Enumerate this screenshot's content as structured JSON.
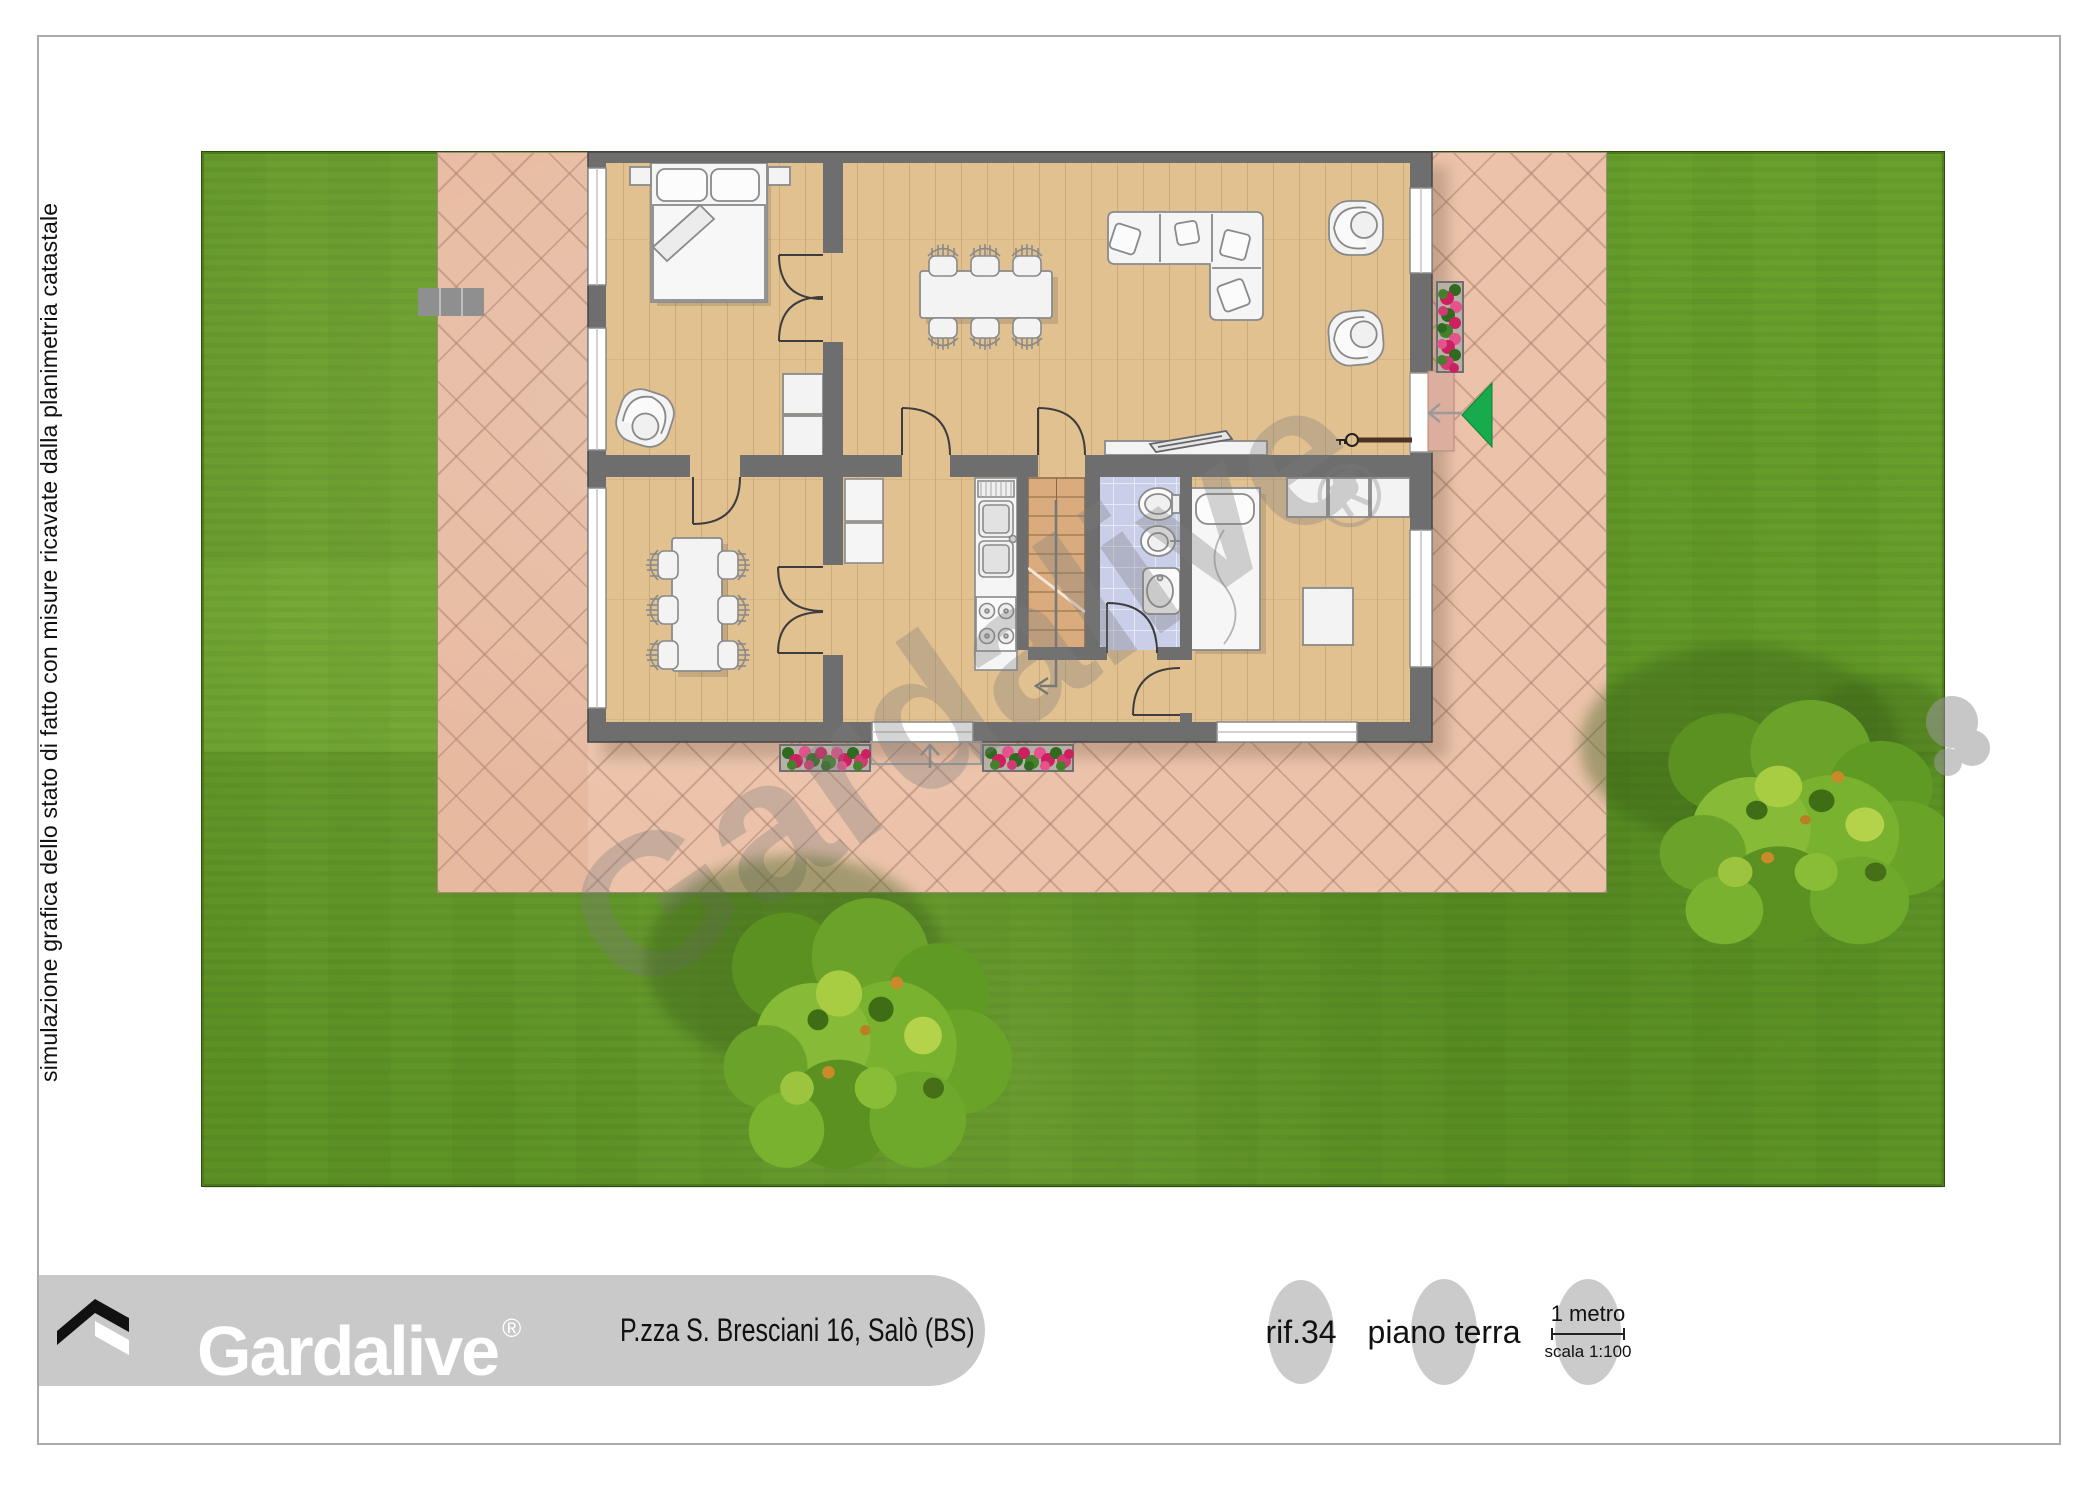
{
  "side_note": "simulazione grafica dello stato di fatto con misure ricavate dalla planimetria catastale",
  "watermark": {
    "text": "Gardalive",
    "registered_mark": "®"
  },
  "footer": {
    "brand": {
      "name": "Gardalive",
      "registered_mark": "®",
      "logo_icon": "gardalive-roof-icon"
    },
    "address": "P.zza S. Bresciani 16, Salò (BS)",
    "reference": "rif.34",
    "floor_label": "piano terra",
    "scale": {
      "bar_label": "1 metro",
      "ratio": "scala 1:100"
    }
  },
  "plan": {
    "type": "residential-floor-plan",
    "rooms": [
      {
        "icon": "bedroom-icon",
        "position": "top-left",
        "furniture": [
          "double-bed-icon",
          "nightstand-icon",
          "nightstand-icon",
          "armchair-icon",
          "cabinet-icon"
        ]
      },
      {
        "icon": "living-room-icon",
        "position": "top-center",
        "furniture": [
          "dining-table-icon",
          "chair-icon",
          "chair-icon",
          "chair-icon",
          "chair-icon",
          "chair-icon",
          "chair-icon",
          "corner-sofa-icon",
          "armchair-icon",
          "armchair-icon",
          "tv-sideboard-icon"
        ]
      },
      {
        "icon": "dining-room-icon",
        "position": "bottom-left",
        "furniture": [
          "table-icon",
          "chair-icon",
          "chair-icon",
          "chair-icon",
          "chair-icon",
          "chair-icon",
          "chair-icon"
        ]
      },
      {
        "icon": "kitchen-icon",
        "position": "bottom-center",
        "furniture": [
          "fridge-icon",
          "sink-icon",
          "stove-icon"
        ]
      },
      {
        "icon": "staircase-icon",
        "position": "bottom-center",
        "furniture": [
          "stairs-direction-arrow-icon"
        ]
      },
      {
        "icon": "bathroom-icon",
        "position": "bottom-center",
        "furniture": [
          "toilet-icon",
          "bidet-icon",
          "washbasin-icon"
        ]
      },
      {
        "icon": "bedroom-icon",
        "position": "bottom-right",
        "furniture": [
          "double-bed-icon",
          "wardrobe-icon",
          "ottoman-icon"
        ]
      }
    ],
    "outdoor": [
      "lawn",
      "paved-patio",
      "tree-icon",
      "tree-icon",
      "flower-planter-icon",
      "flower-planter-icon",
      "flower-planter-icon",
      "entrance-arrow-icon",
      "doormat-icon",
      "garden-steps-icon"
    ],
    "markers": [
      "entrance-arrow-icon",
      "door-key-icon",
      "path-arrow-icon",
      "stairs-direction-arrow-icon"
    ]
  },
  "colors": {
    "lawn": "#6aa12c",
    "patio": "#ecc3aa",
    "wall": "#6e6e6e",
    "wood_floor": "#e2c191",
    "bathroom_tile": "#c9cee9",
    "stairs": "#d9ab7d",
    "entrance_arrow": "#17ab4e",
    "flowers": "#d9336e",
    "footer_bar": "#c9c9c9",
    "badge_ellipse": "#cbcbcb",
    "watermark_gray": "#7d7d7d"
  }
}
